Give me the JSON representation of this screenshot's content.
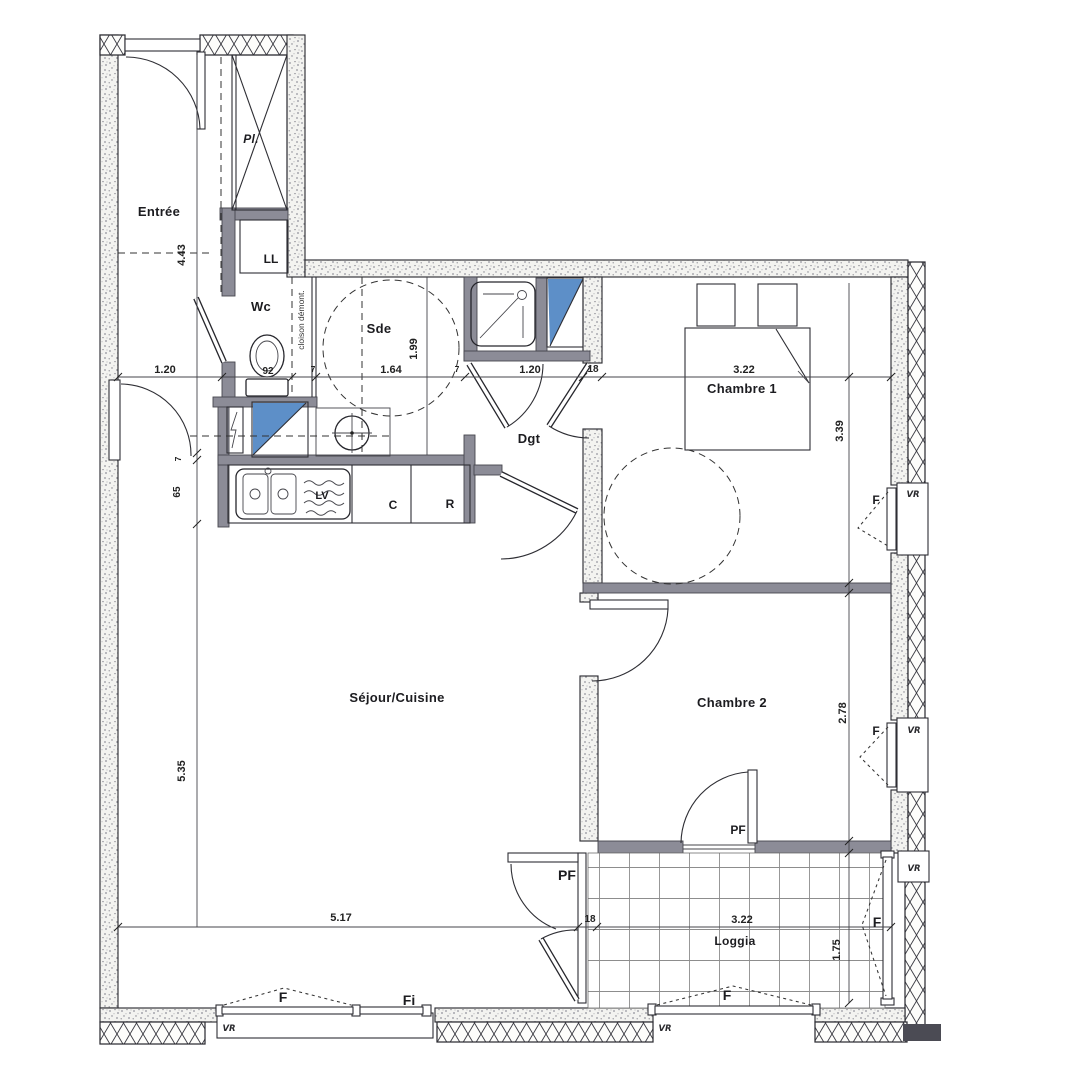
{
  "plan": {
    "rooms": {
      "entree": "Entrée",
      "wc": "Wc",
      "sde": "Sde",
      "dgt": "Dgt",
      "chambre1": "Chambre 1",
      "chambre2": "Chambre 2",
      "sejour_cuisine": "Séjour/Cuisine",
      "loggia": "Loggia",
      "placard": "Pl."
    },
    "equipment": {
      "washing_machine": "LL",
      "dishwasher": "LV",
      "cooker": "C",
      "fridge": "R",
      "partition_note": "cloison démont."
    },
    "openings": {
      "window": "F",
      "fixed_window": "Fi",
      "french_window": "PF",
      "roller_shutter": "VR"
    },
    "dimensions": {
      "entree_length": "4.43",
      "entree_passage": "1.20",
      "wc_width": "92",
      "partition_thickness": "7",
      "sde_width": "1.64",
      "sde_depth": "1.99",
      "dgt_passage": "1.20",
      "wall_thickness": "18",
      "chambre1_width": "3.22",
      "chambre1_depth": "3.39",
      "kitchen_return": "65",
      "sejour_depth": "5.35",
      "chambre2_depth": "2.78",
      "sejour_width": "5.17",
      "loggia_width": "3.22",
      "loggia_depth": "1.75"
    },
    "colors": {
      "fixture_blue": "#5d8fc8",
      "wall_gray": "#8c8c97"
    }
  }
}
